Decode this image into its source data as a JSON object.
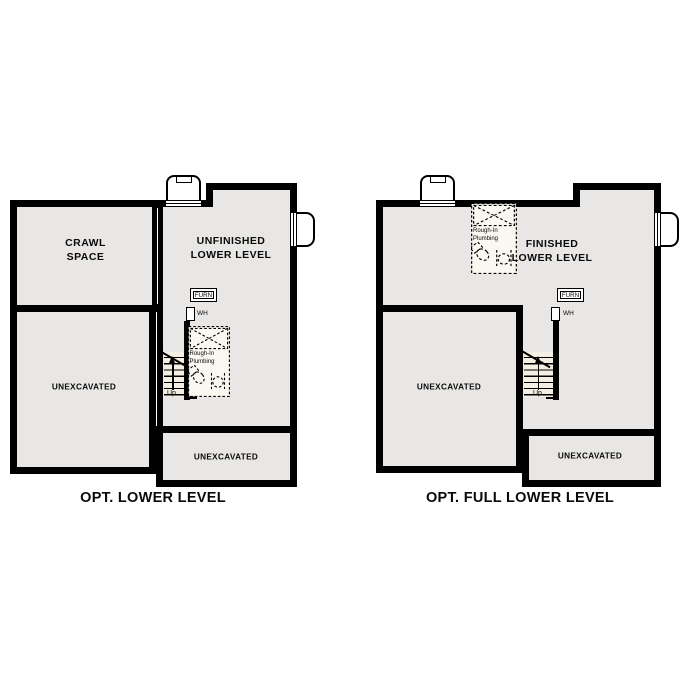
{
  "colors": {
    "wall": "#000000",
    "room_fill": "#e8e7e5",
    "stair_fill": "#f4efe2",
    "fixture_fill": "#faf8f0",
    "background": "#ffffff"
  },
  "plans": {
    "left": {
      "title": "OPT. LOWER LEVEL",
      "crawl_space_line1": "CRAWL",
      "crawl_space_line2": "SPACE",
      "main_room_line1": "UNFINISHED",
      "main_room_line2": "LOWER LEVEL",
      "unexcavated_left": "UNEXCAVATED",
      "unexcavated_bottom": "UNEXCAVATED",
      "furnace": "FURN",
      "water_heater": "WH",
      "up": "Up",
      "plumbing_line1": "Rough-In",
      "plumbing_line2": "Plumbing"
    },
    "right": {
      "title": "OPT. FULL LOWER LEVEL",
      "main_room_line1": "FINISHED",
      "main_room_line2": "LOWER LEVEL",
      "unexcavated_left": "UNEXCAVATED",
      "unexcavated_bottom": "UNEXCAVATED",
      "furnace": "FURN",
      "water_heater": "WH",
      "up": "Up",
      "plumbing_line1": "Rough-In",
      "plumbing_line2": "Plumbing"
    }
  }
}
